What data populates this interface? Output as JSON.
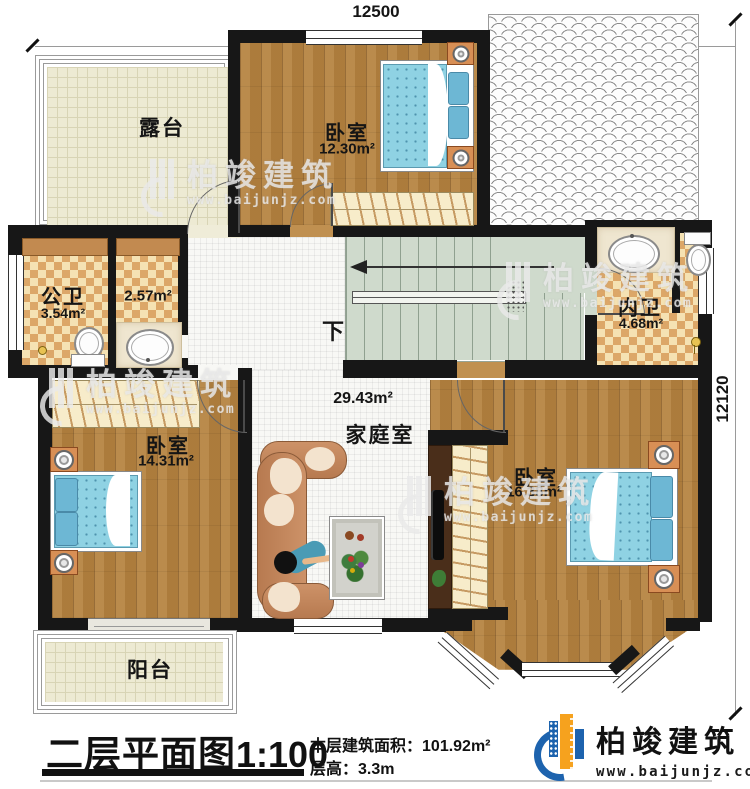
{
  "dimensions": {
    "top": "12500",
    "right": "12120"
  },
  "rooms": {
    "terrace": {
      "name": "露台"
    },
    "bedroom_top": {
      "name": "卧室",
      "area": "12.30m²"
    },
    "public_bath": {
      "name": "公卫",
      "area": "3.54m²"
    },
    "washroom": {
      "area": "2.57m²"
    },
    "inner_bath": {
      "name": "内卫",
      "area": "4.68m²"
    },
    "family_room": {
      "name": "家庭室",
      "area": "29.43m²"
    },
    "bedroom_left": {
      "name": "卧室",
      "area": "14.31m²"
    },
    "bedroom_right": {
      "name": "卧室",
      "area": "16.38m²"
    },
    "balcony": {
      "name": "阳台"
    },
    "stairs": {
      "direction": "下"
    }
  },
  "footer": {
    "title": "二层平面图",
    "scale": "1:100",
    "area_label": "本层建筑面积：",
    "area_value": "101.92m²",
    "floor_height_label": "层高：",
    "floor_height_value": "3.3m"
  },
  "brand": {
    "name": "柏竣建筑",
    "url": "www.baijunjz.com"
  },
  "watermark": {
    "name": "柏竣建筑",
    "url": "www.baijunjz.com"
  },
  "colors": {
    "wall": "#171717",
    "wood_floor": "#b5823f",
    "tile_light": "#f5e2b3",
    "tile_dark": "#dca768",
    "bed_blue": "#8fd2e3",
    "stair_green": "#cfdacc",
    "brand_blue": "#1d63ae",
    "brand_orange": "#f6a21e"
  },
  "icons": {
    "watermark_logo": "baijun-circle-logo",
    "brand_logo": "baijun-circle-logo",
    "stair_arrow": "left-arrow-icon",
    "door_arc": "door-swing-arc"
  }
}
